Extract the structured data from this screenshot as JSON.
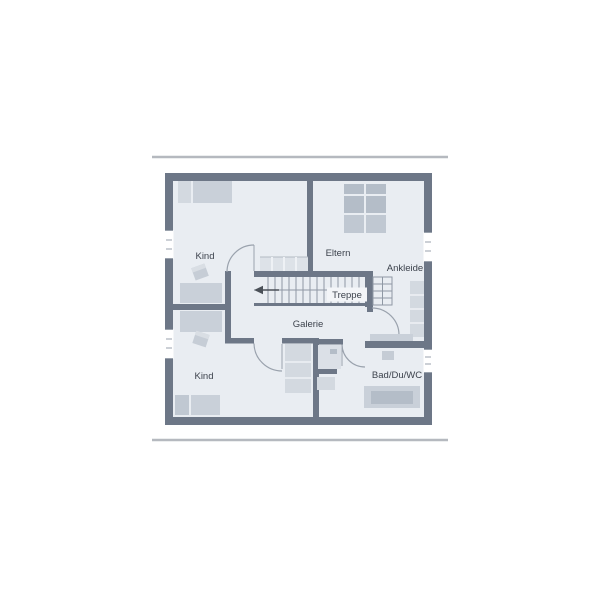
{
  "plan": {
    "labels": {
      "kind_top": "Kind",
      "eltern": "Eltern",
      "ankleide": "Ankleide",
      "treppe": "Treppe",
      "galerie": "Galerie",
      "kind_bottom": "Kind",
      "bad": "Bad/Du/WC"
    },
    "colors": {
      "wall": "#6d7787",
      "floor": "#e9edf2",
      "furn_light": "#d3d9e0",
      "furn_mid": "#c9d0d9",
      "furn_dark": "#b4bdc8",
      "furn_dark2": "#c0c8d2",
      "stair_line": "#8f98a4",
      "door_arc": "#9aa2ad",
      "text": "#3c424c",
      "frame_line": "#b5b9bf",
      "band": "#dde2e8",
      "label_box": "#f3f5f8",
      "arrow": "#4a5058"
    }
  }
}
